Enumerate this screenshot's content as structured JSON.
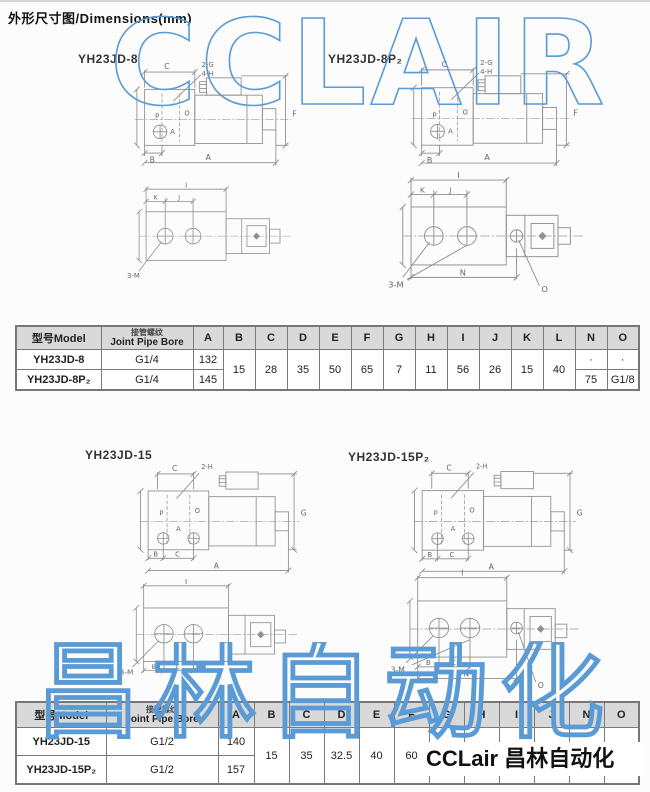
{
  "page": {
    "title": "外形尺寸图/Dimensions(mm)",
    "watermark_top": "CCLAIR",
    "watermark_bottom": "昌林自动化",
    "logo_text": "CCLair 昌林自动化",
    "colors": {
      "watermark_blue": "#5b9bd5",
      "table_header_bg": "#d9d9d9",
      "drawing_line": "#8e8e8e"
    }
  },
  "drawings": {
    "s8": {
      "title": "YH23JD-8"
    },
    "s8p": {
      "title": "YH23JD-8P₂"
    },
    "s15": {
      "title": "YH23JD-15"
    },
    "s15p": {
      "title": "YH23JD-15P₂"
    },
    "labels8": {
      "c": "C",
      "callout1": "2-G",
      "callout2": "4-H",
      "p": "P",
      "o": "O",
      "a": "A",
      "b": "B",
      "a_bottom": "A",
      "f": "F"
    },
    "labels15": {
      "c": "C",
      "callout": "2-H",
      "p": "P",
      "o": "O",
      "a": "A",
      "b": "B",
      "c2": "C",
      "a_bottom": "A",
      "g": "G"
    },
    "bottom8": {
      "i": "I",
      "k": "K",
      "j": "J",
      "m": "3-M"
    },
    "bottom8p": {
      "i": "I",
      "k": "K",
      "j": "J",
      "m": "3-M",
      "n": "N",
      "o": "O"
    },
    "bottom15": {
      "i": "I",
      "b": "B",
      "c": "C",
      "m": "3-M"
    },
    "bottom15p": {
      "i": "I",
      "b": "B",
      "c": "C",
      "m": "3-M",
      "n": "N",
      "o": "O"
    }
  },
  "table1": {
    "header_model": "型号Model",
    "header_bore_cn": "接管螺纹",
    "header_bore_en": "Joint Pipe Bore",
    "columns": [
      "A",
      "B",
      "C",
      "D",
      "E",
      "F",
      "G",
      "H",
      "I",
      "J",
      "K",
      "L",
      "N",
      "O"
    ],
    "merged": [
      "15",
      "28",
      "35",
      "50",
      "65",
      "7",
      "11",
      "56",
      "26",
      "15",
      "40"
    ],
    "rows": [
      {
        "model": "YH23JD-8",
        "bore": "G1/4",
        "a": "132",
        "n": "·",
        "o": "·"
      },
      {
        "model": "YH23JD-8P₂",
        "bore": "G1/4",
        "a": "145",
        "n": "75",
        "o": "G1/8"
      }
    ]
  },
  "table2": {
    "header_model": "型号Model",
    "header_bore_cn": "接管螺纹",
    "header_bore_en": "Joint Pipe Bore",
    "columns": [
      "A",
      "B",
      "C",
      "D",
      "E",
      "F",
      "G",
      "H",
      "I",
      "J",
      "N",
      "O"
    ],
    "merged": [
      "15",
      "35",
      "32.5",
      "40",
      "60",
      "65",
      "7"
    ],
    "merged_hidden": [
      "",
      ""
    ],
    "rows": [
      {
        "model": "YH23JD-15",
        "bore": "G1/2",
        "a": "140",
        "n": "",
        "o": ""
      },
      {
        "model": "YH23JD-15P₂",
        "bore": "G1/2",
        "a": "157",
        "n": "75",
        "o": "G1/8"
      }
    ]
  }
}
